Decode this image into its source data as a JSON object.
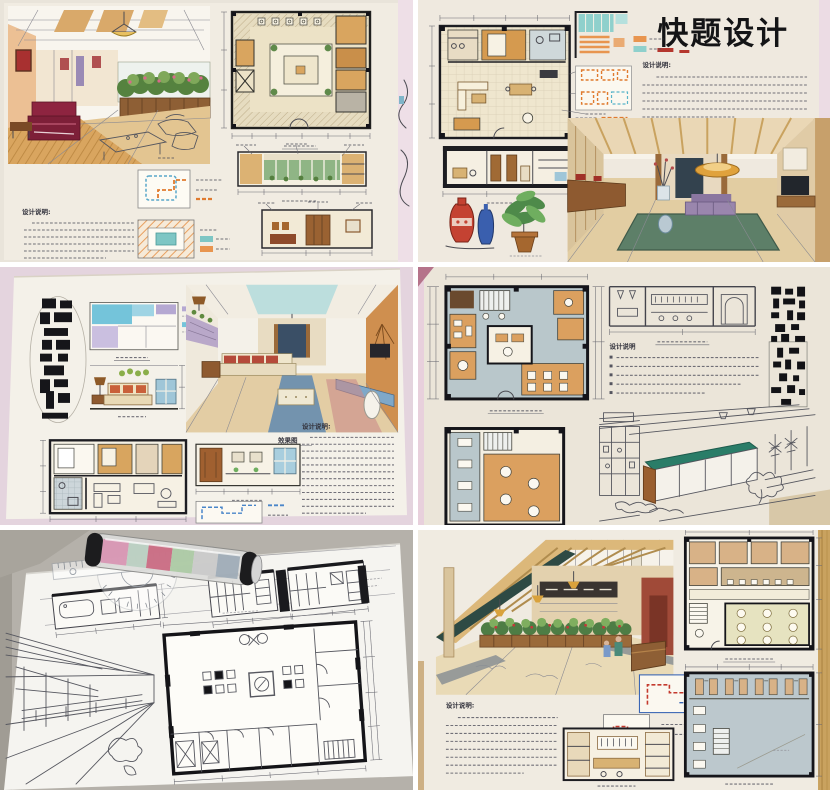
{
  "meta": {
    "description": "Photo collage, 2 columns x 3 rows, of six photographs of hand-drawn interior design presentation boards (marker renderings, floor plans, elevations, handwritten Chinese notes); one sheet has a protractor ruler and a clear drawing tube lying on it."
  },
  "collage": {
    "rows": 3,
    "cols": 2,
    "gutter_color": "#ffffff"
  },
  "panels": [
    {
      "name": "hotel-lobby-board",
      "notes_heading": "设计说明:"
    },
    {
      "name": "quick-sketch-design-board",
      "title": "快题设计",
      "notes_heading": "设计说明:"
    },
    {
      "name": "living-room-board",
      "notes_heading": "设计说明:",
      "perspective_caption": "效果图"
    },
    {
      "name": "teahouse-bar-board",
      "notes_heading": "设计说明"
    },
    {
      "name": "ink-drafting-sheet"
    },
    {
      "name": "cafe-restaurant-board",
      "notes_heading": "设计说明:"
    }
  ],
  "palette": {
    "wall_pink": "#e6d6e0",
    "board_paper": "#f1ece2",
    "marker_wood_tan": "#d8a55f",
    "marker_teal": "#7ec6c4",
    "sofa_maroon": "#8e2440",
    "bar_counter_green": "#2a7d68",
    "wood_table_edge": "#c9a25f",
    "ink_line": "#4b4b52",
    "circulation_orange": "#e07a2e",
    "circulation_red": "#c43a2e",
    "circulation_blue": "#3a66b5"
  }
}
